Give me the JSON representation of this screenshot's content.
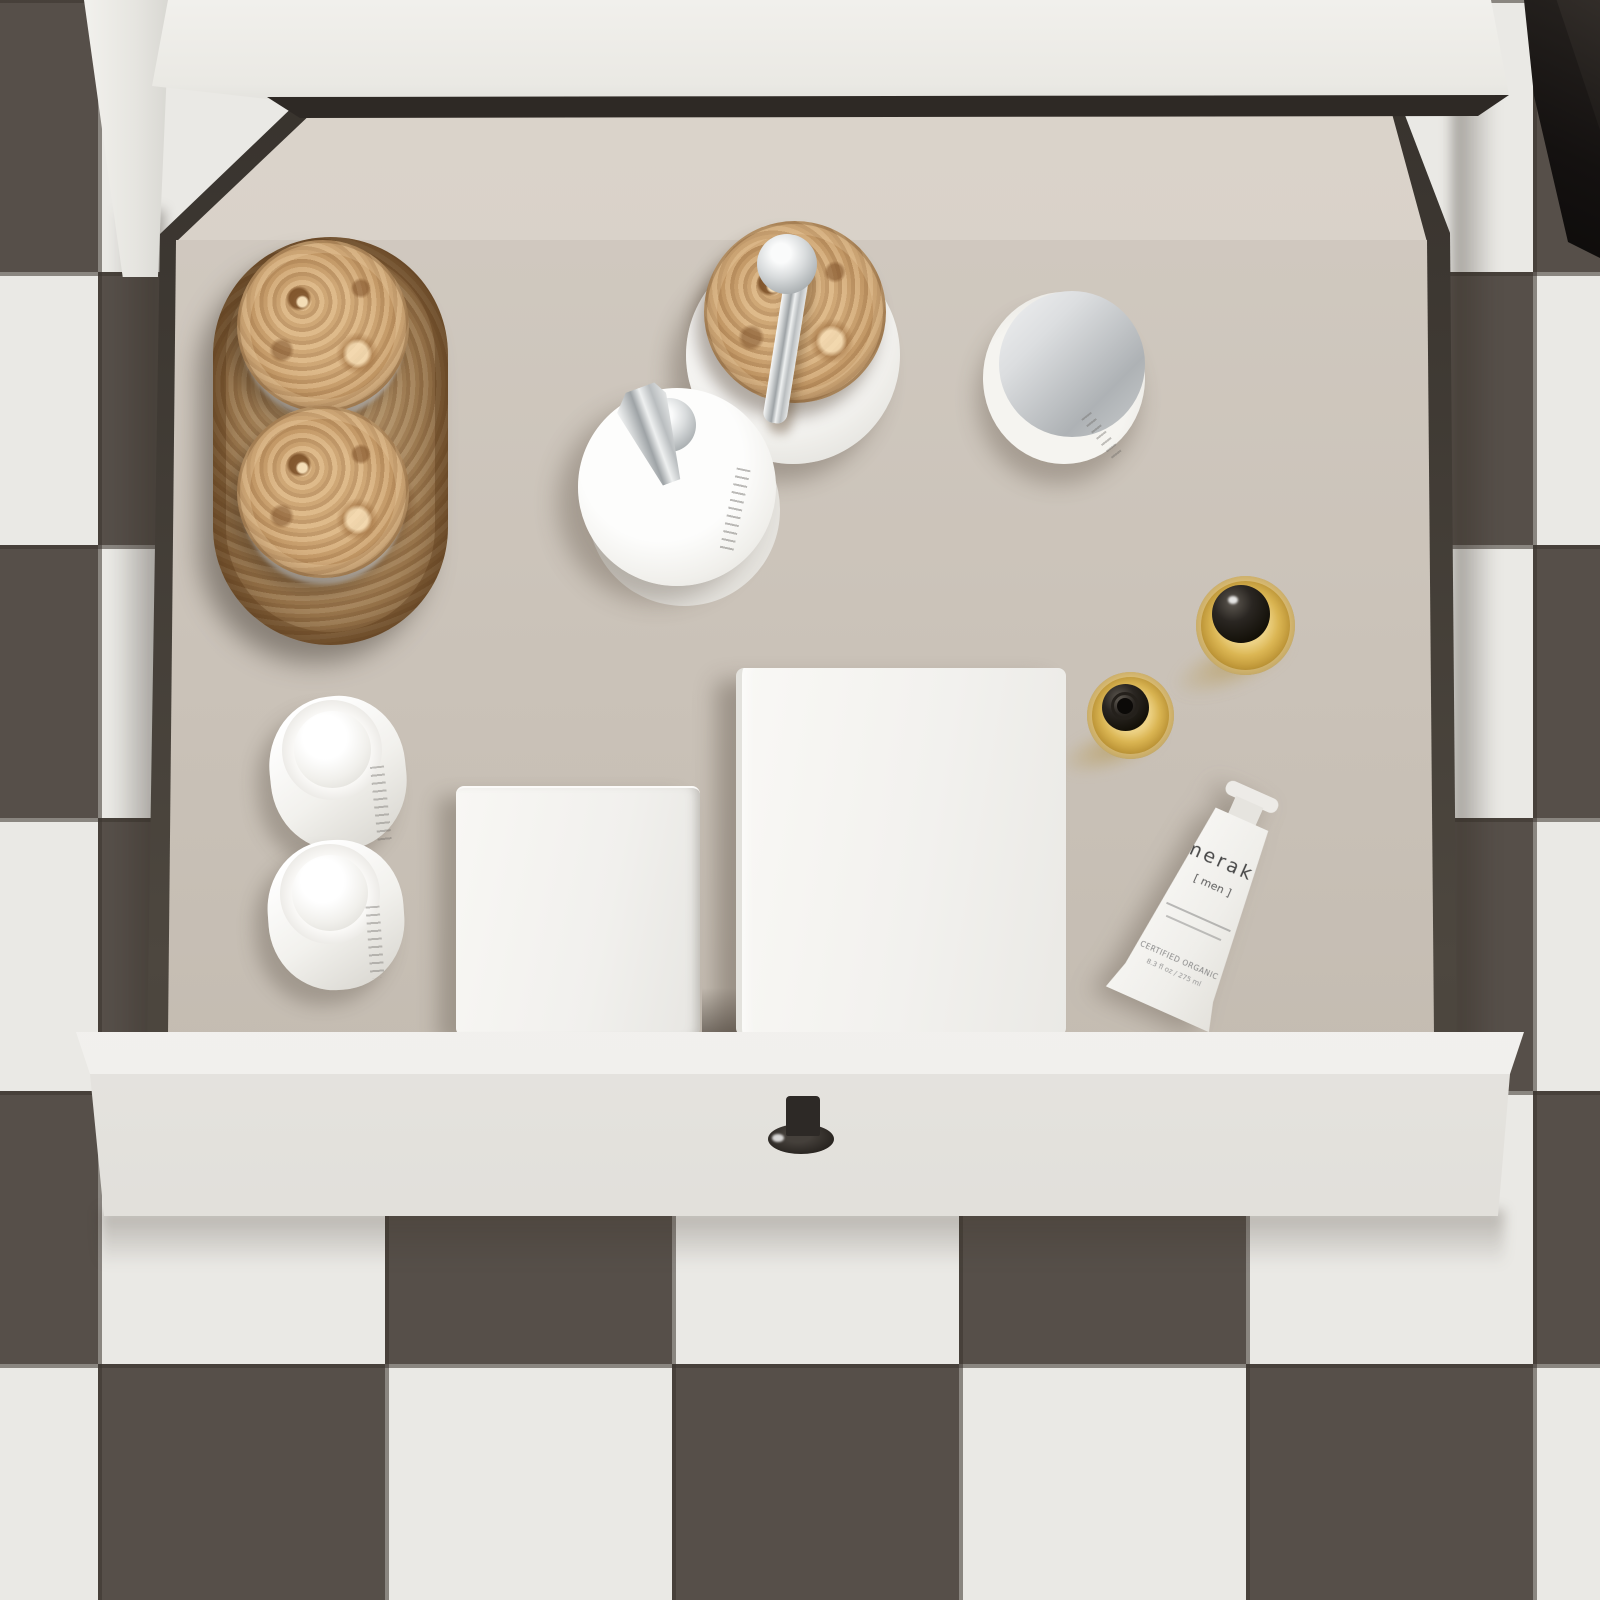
{
  "products": {
    "meraki_tube": {
      "brand": "meraki",
      "variant": "[ men ]",
      "certification": "CERTIFIED ORGANIC",
      "volume": "8.3 fl oz / 275 ml"
    }
  },
  "items": [
    "wooden-oval-tray",
    "wooden-lid-jar",
    "wooden-lid-jar",
    "soap-dispenser-wood-lid",
    "white-pump-bottle",
    "chrome-lid-jar",
    "amber-dropper-bottle",
    "amber-dropper-bottle",
    "meraki-tube",
    "white-dome-bottle",
    "white-dome-bottle",
    "white-box-small",
    "white-box-large"
  ],
  "palette": {
    "tile_dark": "#564f49",
    "tile_light": "#eae9e5",
    "grout": "#3a342e",
    "drawer_interior": "#cac2b8",
    "drawer_rim": "#46403a",
    "cabinet_white": "#efeeea",
    "knob_black": "#2b2724",
    "wood_base": "#c79d6b",
    "wood_dark": "#7d5630",
    "chrome": "#c9cccd",
    "amber_glass": "#d3ab4a",
    "shadow": "#4a4036"
  }
}
